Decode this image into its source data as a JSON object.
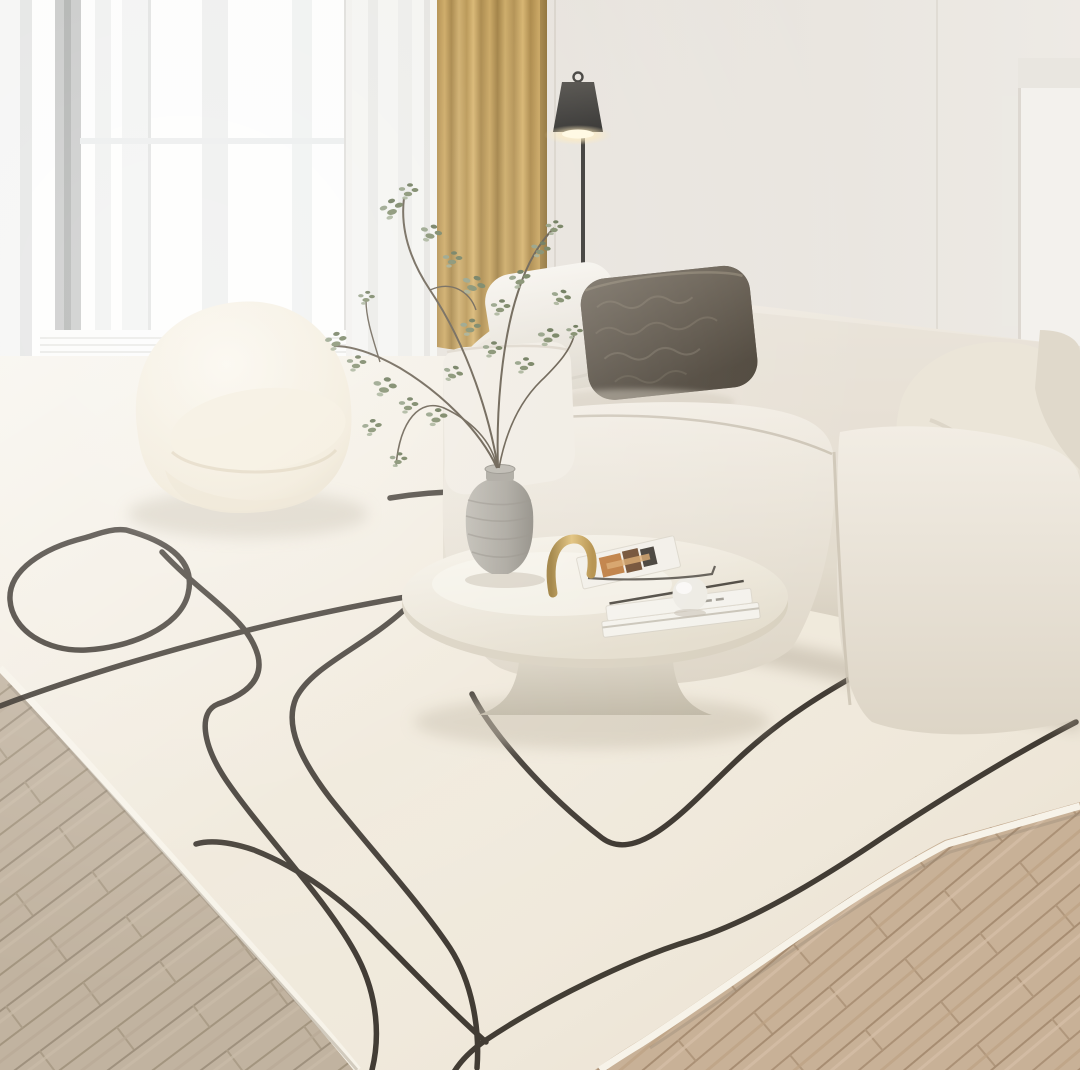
{
  "scene": {
    "type": "natural-photo",
    "description": "Bright minimalist living room in cream tones: sheer-curtained window and a mustard drape on the left, a lit black floor lamp, a cream modular fabric sofa with white and dark taupe cushions, a cream boucle pod chair, a round white pedestal coffee table holding white books, an open magazine, a brass arc, a white sphere and a gray stone vase with leafy branches, all standing on a cream rug with a black abstract line pattern laid over a herringbone wood floor.",
    "objects": [
      "window with sheer curtains",
      "mustard curtain panel",
      "black floor lamp (lit)",
      "white wall column",
      "cream modular sofa",
      "white throw pillow",
      "dark taupe textured pillow",
      "cream leaning cushion",
      "cream boucle pod chair",
      "gray stone vase with branches",
      "round white pedestal coffee table",
      "stack of white books",
      "open magazine",
      "brass arc ornament",
      "white sphere ornament",
      "cream rug with black line art",
      "herringbone wood floor"
    ]
  },
  "palette": {
    "wall": "#e4dfd8",
    "window_white": "#fdfdfc",
    "sheer_gray": "#e7e8e7",
    "curtain_gold": "#bb9446",
    "curtain_gold_dark": "#93702e",
    "lamp_black": "#2c2a27",
    "lamp_glow": "#ffeab4",
    "column_white": "#f3f1ed",
    "sofa_cream": "#ebe5da",
    "sofa_shadow": "#c9c0b0",
    "pillow_white": "#f3f0e9",
    "pillow_dark": "#5e564a",
    "cushion_cream": "#ebe5d8",
    "chair_cream": "#f6f1e4",
    "rug_cream": "#f0e9db",
    "rug_line": "#2b251e",
    "wood_left": "#c1b3a0",
    "wood_left_gap": "#9f917e",
    "wood_right": "#c8b197",
    "wood_right_gap": "#a78d72",
    "table_white": "#f1ece1",
    "vase_gray": "#a8a49b",
    "plant_green": "#6f7d59",
    "brass": "#c39d52",
    "book_white": "#f4f2ec",
    "sphere_white": "#edebe4"
  }
}
